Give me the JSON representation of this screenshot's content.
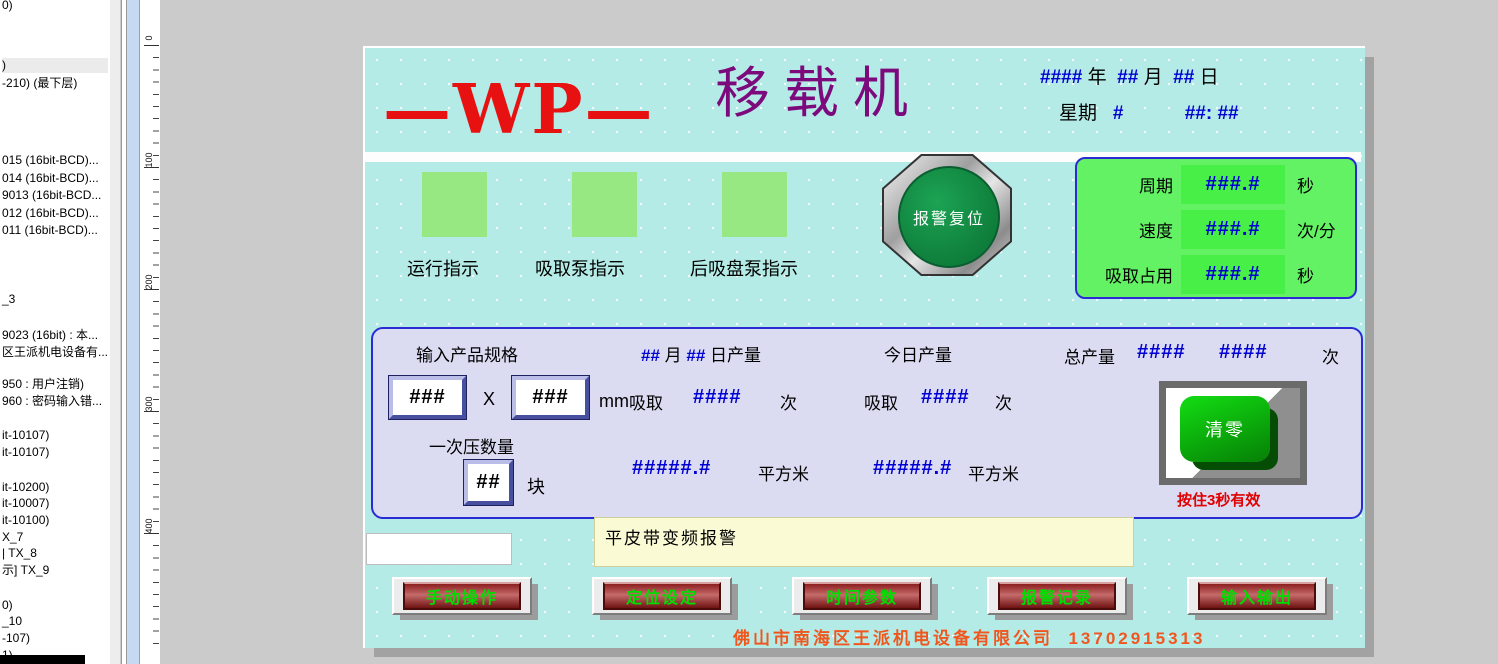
{
  "sidebar": {
    "items": [
      {
        "label": "0)"
      },
      {
        "label": ")",
        "highlighted": true
      },
      {
        "label": "-210) (最下层)"
      },
      {
        "label": "015 (16bit-BCD)..."
      },
      {
        "label": "014 (16bit-BCD)..."
      },
      {
        "label": "9013 (16bit-BCD..."
      },
      {
        "label": "012 (16bit-BCD)..."
      },
      {
        "label": "011 (16bit-BCD)..."
      },
      {
        "label": "_3"
      },
      {
        "label": "9023 (16bit) : 本..."
      },
      {
        "label": "区王派机电设备有..."
      },
      {
        "label": "950 : 用户注销)"
      },
      {
        "label": "960 : 密码输入错..."
      },
      {
        "label": "it-10107)"
      },
      {
        "label": "it-10107)"
      },
      {
        "label": "it-10200)"
      },
      {
        "label": "it-10007)"
      },
      {
        "label": "it-10100)"
      },
      {
        "label": "X_7"
      },
      {
        "label": "| TX_8"
      },
      {
        "label": "示] TX_9"
      },
      {
        "label": "0)"
      },
      {
        "label": "_10"
      },
      {
        "label": "-107)"
      },
      {
        "label": "1)"
      }
    ]
  },
  "ruler": {
    "labels": [
      "0",
      "100",
      "200",
      "300",
      "400"
    ]
  },
  "screen": {
    "logo": "—WP—",
    "title": "移载机",
    "datetime": {
      "year_val": "####",
      "year_label": "年",
      "month_val": "##",
      "month_label": "月",
      "day_val": "##",
      "day_label": "日",
      "week_label": "星期",
      "week_val": "#",
      "time_val": "##: ##"
    },
    "indicators": [
      {
        "label": "运行指示"
      },
      {
        "label": "吸取泵指示"
      },
      {
        "label": "后吸盘泵指示"
      }
    ],
    "alarm_reset_button": "报警复位",
    "stats_panel": {
      "rows": [
        {
          "label": "周期",
          "value": "###.#",
          "unit": "秒"
        },
        {
          "label": "速度",
          "value": "###.#",
          "unit": "次/分"
        },
        {
          "label": "吸取占用",
          "value": "###.#",
          "unit": "秒"
        }
      ]
    },
    "production_panel": {
      "spec_label": "输入产品规格",
      "daily": {
        "month_val": "##",
        "month_label": "月",
        "day_val": "##",
        "day_label": "日产量"
      },
      "today_label": "今日产量",
      "total_label": "总产量",
      "total_val1": "####",
      "total_val2": "####",
      "total_unit": "次",
      "spec_w": "###",
      "spec_x": "X",
      "spec_h": "###",
      "spec_unit": "mm",
      "suction1_label": "吸取",
      "suction1_val": "####",
      "suction1_unit": "次",
      "suction2_label": "吸取",
      "suction2_val": "####",
      "suction2_unit": "次",
      "press_label": "一次压数量",
      "press_val": "##",
      "press_unit": "块",
      "area1_val": "#####.#",
      "area1_unit": "平方米",
      "area2_val": "#####.#",
      "area2_unit": "平方米",
      "clear_button": "清零",
      "clear_hint": "按住3秒有效"
    },
    "alarm_bar": "平皮带变频报警",
    "nav_buttons": [
      "手动操作",
      "定位设定",
      "时间参数",
      "报警记录",
      "输入输出"
    ],
    "footer": {
      "company": "佛山市南海区王派机电设备有限公司",
      "phone": "13702915313"
    }
  },
  "colors": {
    "screen_bg": "#b4ebe6",
    "panel_green": "#63f263",
    "value_green": "#47ef47",
    "indicator_green": "#97e883",
    "value_blue": "#0000d2",
    "logo_red": "#e81111",
    "title_purple": "#7d0a7d",
    "panel_lavender": "#dbdbf2",
    "panel_border_blue": "#2b2bd5",
    "alarm_yellow": "#fafad4",
    "button_red": "#8c1f1f",
    "button_text_green": "#00dd00",
    "footer_orange": "#f0571e",
    "hint_red": "#e00000"
  }
}
